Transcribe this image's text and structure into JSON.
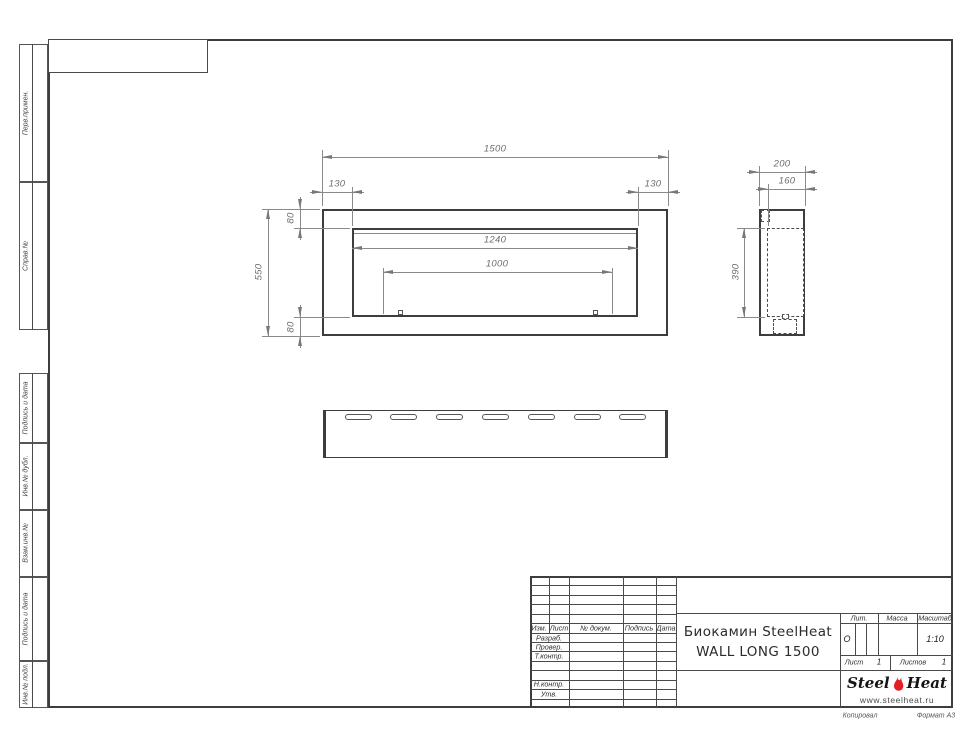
{
  "margin_columns": [
    "Перв.примен.",
    "Справ.№",
    "Подпись и дата",
    "Инв.№ дубл.",
    "Взам.инв.№",
    "Подпись и дата",
    "Инв.№ подл."
  ],
  "dimensions": {
    "front_width": "1500",
    "front_offset_left": "130",
    "front_offset_right": "130",
    "front_top": "80",
    "front_bottom": "80",
    "front_height": "550",
    "opening_width": "1240",
    "burner_width": "1000",
    "side_depth": "200",
    "side_inner_depth": "160",
    "side_inner_height": "390"
  },
  "title_block": {
    "revision_cols": [
      "Изм.",
      "Лист",
      "№ докум.",
      "Подпись",
      "Дата"
    ],
    "signature_rows": [
      "Разраб.",
      "Провер.",
      "Т.контр.",
      "Н.контр.",
      "Утв."
    ],
    "doc_title_line1": "Биокамин SteelHeat",
    "doc_title_line2": "WALL LONG 1500",
    "lit": {
      "label": "Лит.",
      "value": "О"
    },
    "mass": {
      "label": "Масса",
      "value": ""
    },
    "scale": {
      "label": "Масштаб",
      "value": "1:10"
    },
    "sheet": {
      "label": "Лист",
      "value": "1"
    },
    "sheets": {
      "label": "Листов",
      "value": "1"
    },
    "logo": {
      "word1": "Steel",
      "word2": "Heat",
      "website": "www.steelheat.ru"
    }
  },
  "footer": {
    "copied_by": "Копировал",
    "format": "Формат А3"
  },
  "colors": {
    "flame": "#e31e24",
    "line_main": "#3d3d3d",
    "line_dim": "#8a8a8a"
  }
}
